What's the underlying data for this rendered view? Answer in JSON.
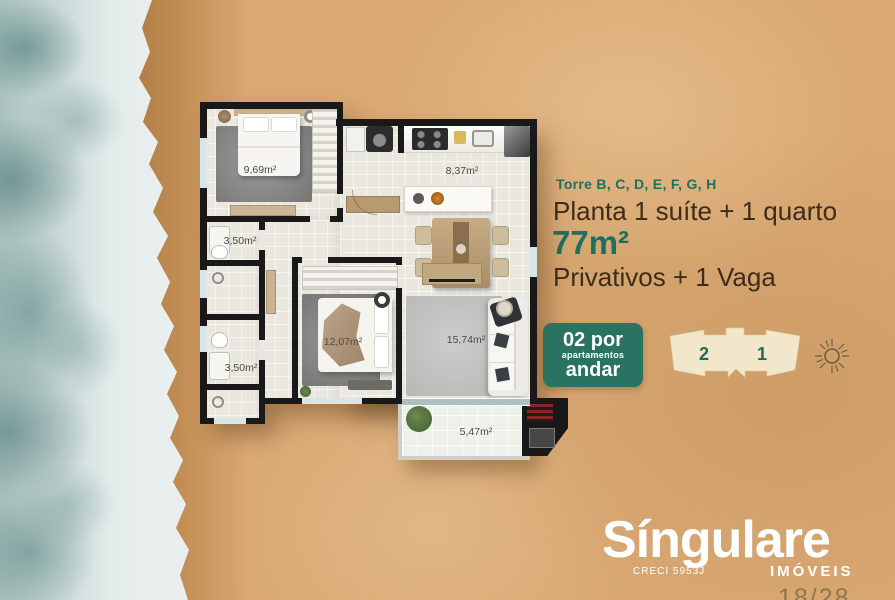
{
  "panel": {
    "towers": "Torre B, C, D, E, F, G, H",
    "title": "Planta 1 suíte + 1 quarto",
    "area": "77m²",
    "subtitle": "Privativos + 1 Vaga",
    "badge": {
      "line1": "02 por",
      "line2": "apartamentos",
      "line3": "andar"
    },
    "footprint": {
      "left_unit": "2",
      "right_unit": "1"
    }
  },
  "floorplan": {
    "labels": {
      "suite": "9,69m²",
      "suite_bath": "3,50m²",
      "social_bath": "3,50m²",
      "kitchen": "8,37m²",
      "bedroom": "12,07m²",
      "living": "15,74m²",
      "balcony": "5,47m²"
    }
  },
  "branding": {
    "name": "Síngulare",
    "creci": "CRECI 5953J",
    "segment": "IMÓVEIS"
  },
  "page_indicator": "18/28",
  "colors": {
    "teal": "#1f6f60",
    "text_dark": "#3e2c1a",
    "badge_bg": "#2a7261",
    "sand": "#d9a873",
    "footprint_fill": "#f2e7cb",
    "wall": "#191919"
  },
  "icons": [
    "sun-icon",
    "plant-icon",
    "shower-icon",
    "grill-icon"
  ]
}
